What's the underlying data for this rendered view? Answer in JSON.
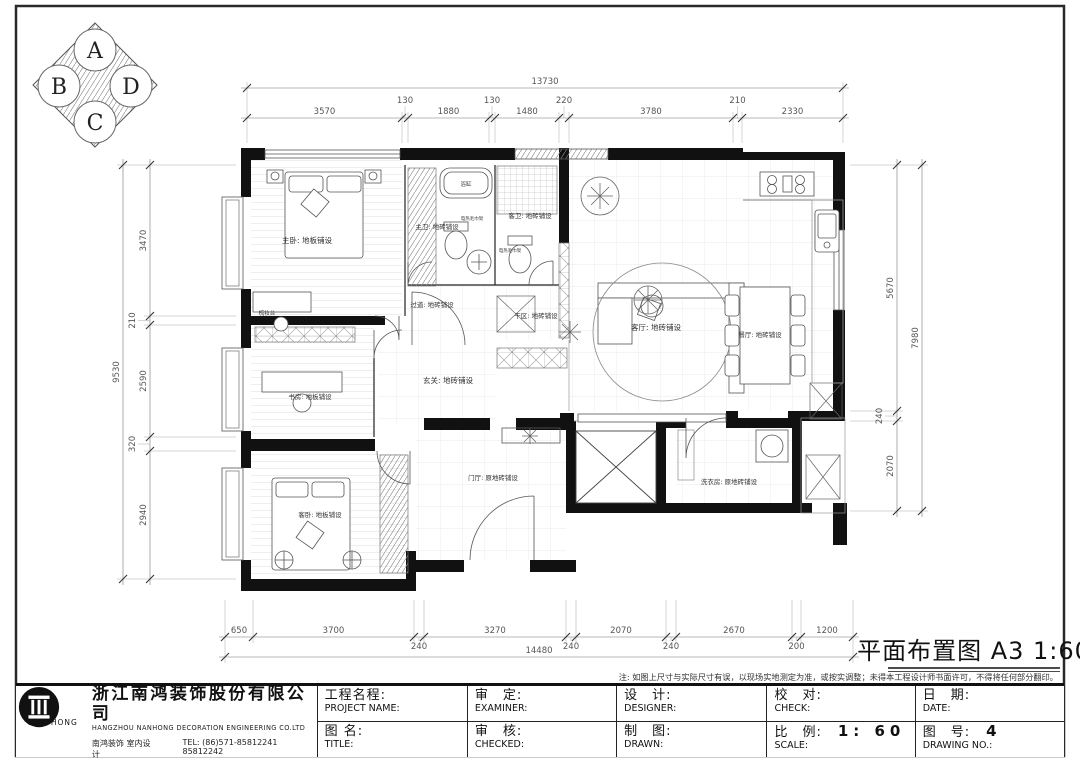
{
  "sheet": {
    "title_full": "平面布置图 A3 1:60",
    "note": "注: 如图上尺寸与实际尺寸有误，以现场实地测定为准，或按实调整；未得本工程设计师书面许可，不得将任何部分翻印。"
  },
  "compass": {
    "a": "A",
    "b": "B",
    "c": "C",
    "d": "D"
  },
  "dims": {
    "top": {
      "overall": "13730",
      "segments": [
        "3570",
        "130",
        "1880",
        "130",
        "1480",
        "220",
        "3780",
        "210",
        "2330"
      ]
    },
    "bottom": {
      "overall": "14480",
      "segments": [
        "650",
        "3700",
        "240",
        "3270",
        "240",
        "2070",
        "240",
        "2670",
        "200",
        "1200"
      ]
    },
    "left": {
      "overall": "9530",
      "segments": [
        "3470",
        "210",
        "2590",
        "320",
        "2940"
      ]
    },
    "right": {
      "overall": "7980",
      "segments": [
        "5670",
        "240",
        "2070"
      ]
    }
  },
  "rooms": {
    "master_bedroom": "主卧: 地板铺设",
    "master_bath": "主卫: 地砖铺设",
    "bathtub": "浴缸",
    "towel_rack_master": "电热毛巾架",
    "guest_bath": "客卫: 地砖铺设",
    "towel_rack_guest": "电热毛巾架",
    "corridor": "过道: 地砖铺设",
    "dry_area": "干区: 地砖铺设",
    "living": "客厅: 地砖铺设",
    "dining": "餐厅: 地砖铺设",
    "entry": "玄关: 地砖铺设",
    "study": "书房: 地板铺设",
    "guest_bedroom": "客卧: 地板铺设",
    "foyer": "门厅: 原地砖铺设",
    "laundry": "洗衣房: 原地砖铺设",
    "dresser": "梳妆台"
  },
  "company": {
    "name_cn": "浙江南鸿装饰股份有限公司",
    "name_en": "HANGZHOU  NANHONG  DECORATION  ENGINEERING  CO.LTD",
    "dept": "南鸿装饰    室内设计",
    "tel": "TEL:   (86)571-85812241   85812242",
    "logo_text": "NAN HONG"
  },
  "titleblock": {
    "project_cn": "工程名程:",
    "project_en": "PROJECT NAME:",
    "title_cn": "图 名:",
    "title_en": "TITLE:",
    "examine_cn": "审　定:",
    "examine_en": "EXAMINER:",
    "checked_cn": "审　核:",
    "checked_en": "CHECKED:",
    "design_cn": "设　计:",
    "design_en": "DESIGNER:",
    "drawn_cn": "制　图:",
    "drawn_en": "DRAWN:",
    "check2_cn": "校　对:",
    "check2_en": "CHECK:",
    "scale_cn": "比　例:",
    "scale_value": "1: 60",
    "scale_en": "SCALE:",
    "date_cn": "日　期:",
    "date_en": "DATE:",
    "no_cn": "图　号:",
    "no_value": "4",
    "no_en": "DRAWING NO.:"
  }
}
